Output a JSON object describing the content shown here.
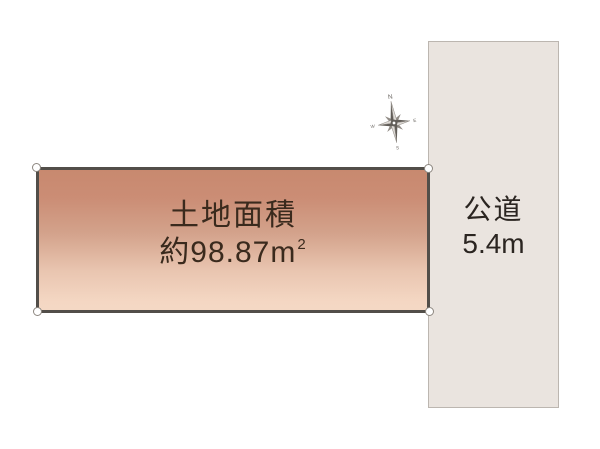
{
  "window": {
    "width_px": 600,
    "height_px": 449,
    "background_color": "#ffffff"
  },
  "parcel": {
    "title": "土地面積",
    "area_prefix": "約98.87",
    "area_unit": "m",
    "area_exponent": "2",
    "fill_gradient_top": "#cb8d75",
    "fill_gradient_bottom": "#f4d8c4",
    "border_color": "#524e49",
    "text_color": "#3a2a1d"
  },
  "road": {
    "name": "公道",
    "width_label": "5.4m",
    "fill_color": "#eae4df",
    "border_color": "#bcb6b0",
    "text_color": "#2b2521"
  },
  "compass": {
    "north_label": "N",
    "east_label": "E",
    "south_label": "S",
    "west_label": "W",
    "color": "#6e6a65",
    "rotation_deg": -8
  }
}
